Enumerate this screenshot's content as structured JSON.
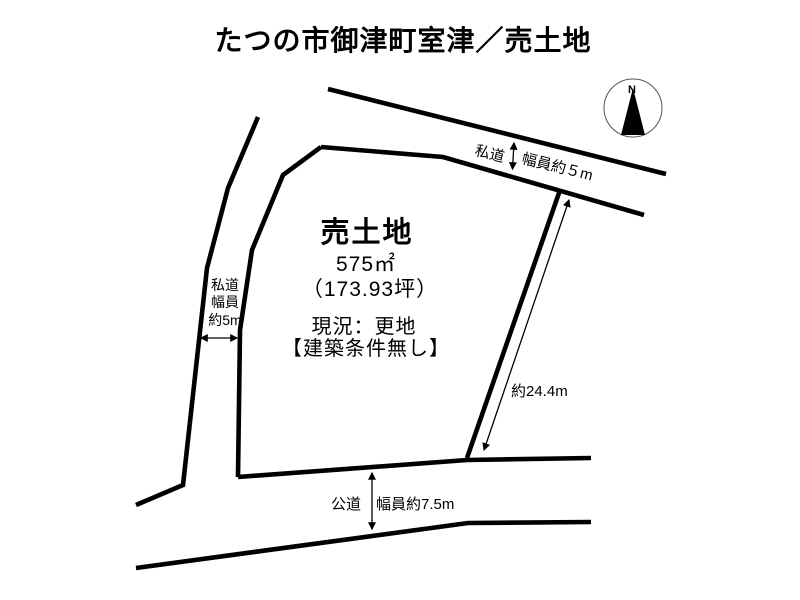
{
  "page": {
    "title": "たつの市御津町室津／売土地"
  },
  "compass": {
    "north_label": "N"
  },
  "roads": {
    "top": {
      "type": "private",
      "name": "私道",
      "width_label": "幅員約５m"
    },
    "left": {
      "type": "private",
      "name": "私道",
      "width_line1": "幅員",
      "width_line2": "約5m"
    },
    "bottom": {
      "type": "public",
      "name": "公道",
      "width_label": "幅員約7.5m"
    }
  },
  "plot": {
    "label": "売土地",
    "area_sqm": "575㎡",
    "area_tsubo": "（173.93坪）",
    "current_state": "現況：更地",
    "building_condition": "【建築条件無し】",
    "east_side_length": "約24.4m"
  },
  "colors": {
    "line": "#000000",
    "background": "#ffffff"
  }
}
